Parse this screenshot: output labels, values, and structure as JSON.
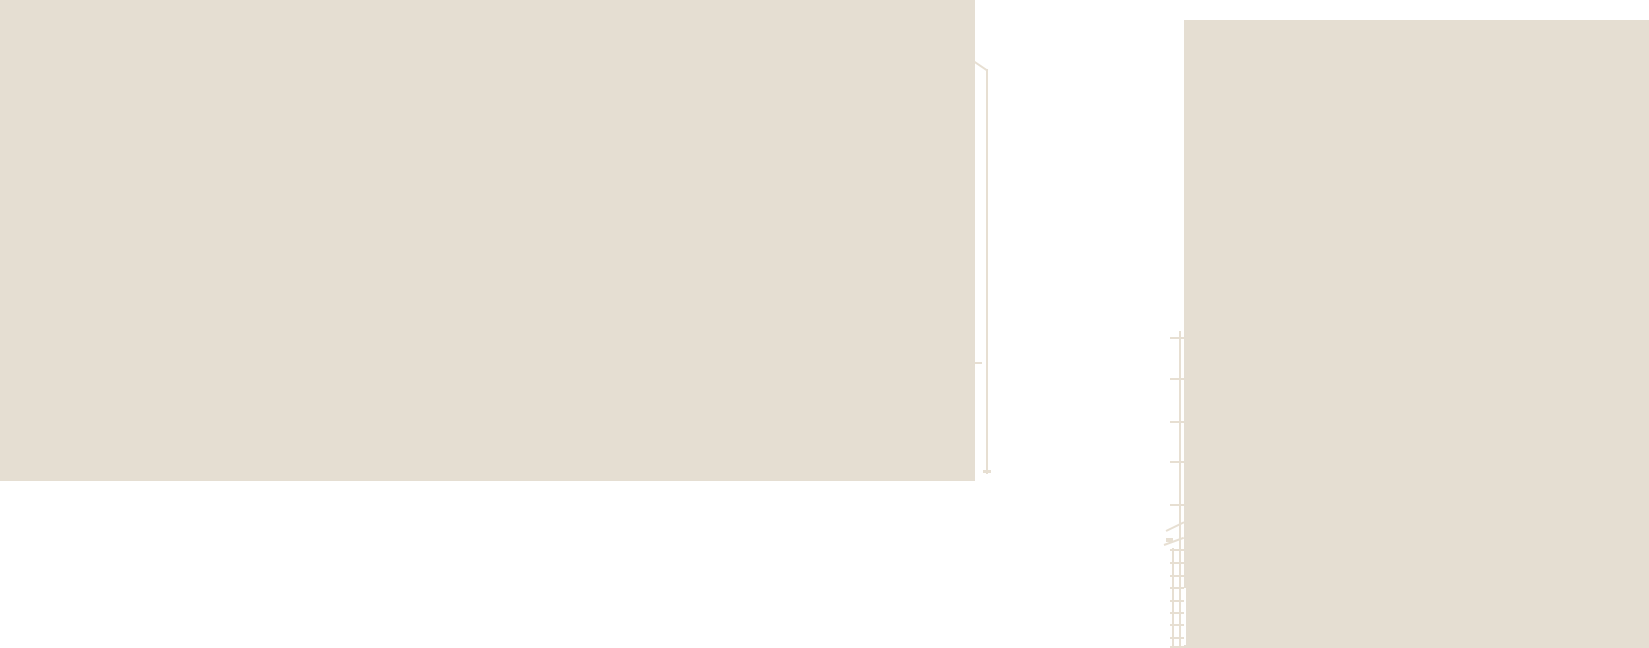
{
  "scene": {
    "type": "overexposed-photograph",
    "description": "Heavily overexposed photo: two flat pale-beige building walls against a blown-out white sky; a thin rooftop pole and narrow duct at the right edge of the left building, and a wall-mounted ladder with spaced brackets and faint cables on the left edge of the right building.",
    "colors": {
      "background": "#ffffff",
      "wall": "#e5ded2",
      "line": "#e7dfd2",
      "seam": "#ffffff"
    },
    "elements": [
      "left-building-wall",
      "roof-diagonal-line",
      "rooftop-pole",
      "wall-duct-strip",
      "right-building-wall",
      "standpipe-rail",
      "wall-brackets",
      "wall-ladder",
      "hanging-cables"
    ]
  }
}
